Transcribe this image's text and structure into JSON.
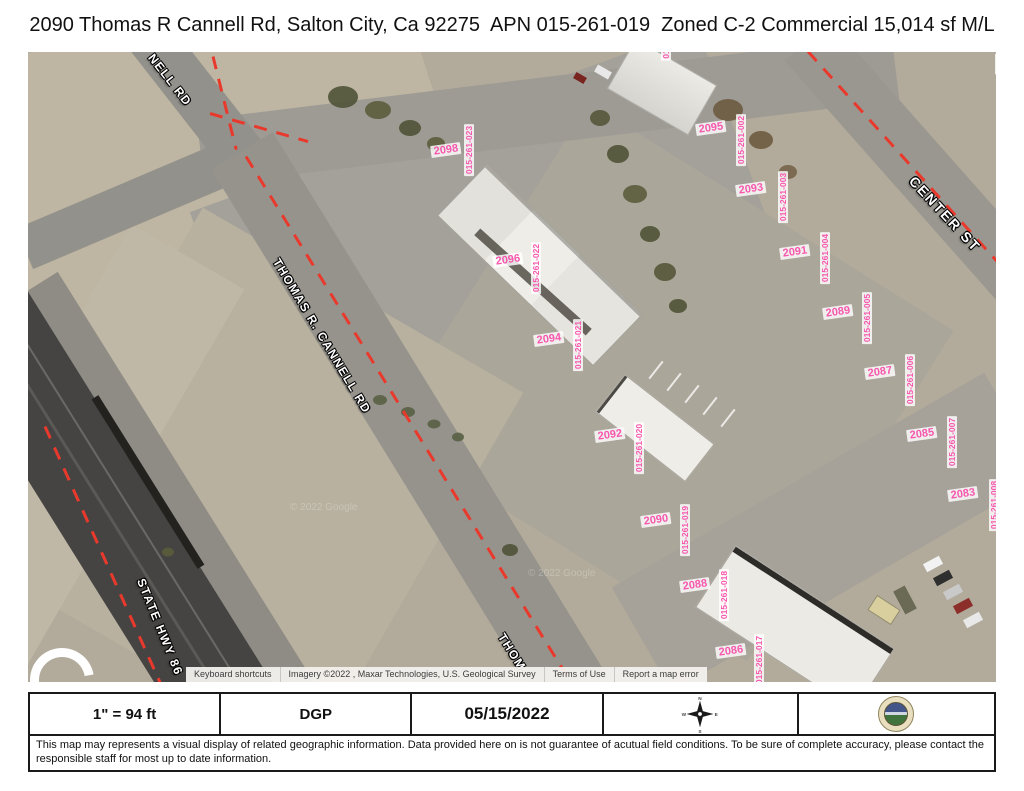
{
  "title": "2090 Thomas R Cannell Rd, Salton City, Ca 92275  APN 015-261-019  Zoned C-2 Commercial 15,014 sf M/L",
  "map": {
    "street_labels": {
      "nell_rd": "NELL RD",
      "thomas_r_cannell_rd": "THOMAS R. CANNELL RD",
      "state_hwy_86": "STATE HWY 86",
      "thom": "THOM",
      "center_st": "CENTER ST"
    },
    "parcels": [
      {
        "number": "2098",
        "apn": "015-261-023"
      },
      {
        "number": "2096",
        "apn": "015-261-022"
      },
      {
        "number": "2094",
        "apn": "015-261-021"
      },
      {
        "number": "2092",
        "apn": "015-261-020"
      },
      {
        "number": "2090",
        "apn": "015-261-019"
      },
      {
        "number": "2088",
        "apn": "015-261-018"
      },
      {
        "number": "2086",
        "apn": "015-261-017"
      },
      {
        "number": "2095",
        "apn": "015-261-002"
      },
      {
        "number": "2093",
        "apn": "015-261-003"
      },
      {
        "number": "2091",
        "apn": "015-261-004"
      },
      {
        "number": "2089",
        "apn": "015-261-005"
      },
      {
        "number": "2087",
        "apn": "015-261-006"
      },
      {
        "number": "2085",
        "apn": "015-261-007"
      },
      {
        "number": "2083",
        "apn": "015-261-008"
      }
    ],
    "truncated_apn_right": "015-",
    "truncated_apn_top": "01",
    "watermark": "© 2022 Google",
    "attribution": {
      "keyboard_shortcuts": "Keyboard shortcuts",
      "imagery": "Imagery ©2022 , Maxar Technologies, U.S. Geological Survey",
      "terms": "Terms of Use",
      "report": "Report a map error"
    }
  },
  "footer": {
    "scale": "1\" = 94 ft",
    "preparer": "DGP",
    "date": "05/15/2022",
    "compass": {
      "n": "N",
      "e": "E",
      "s": "S",
      "w": "W"
    },
    "disclaimer": "This map may represents a visual display of related geographic information. Data provided here on is not guarantee of acutual field conditions. To be sure of complete accuracy, please contact the responsible staff for most up to date information."
  },
  "colors": {
    "parcel_label_pink": "#f857ae",
    "boundary_red": "#e8392c",
    "desert_ground": "#b2ab9b",
    "road_grey": "#96938d",
    "highway_dark": "#454442"
  }
}
